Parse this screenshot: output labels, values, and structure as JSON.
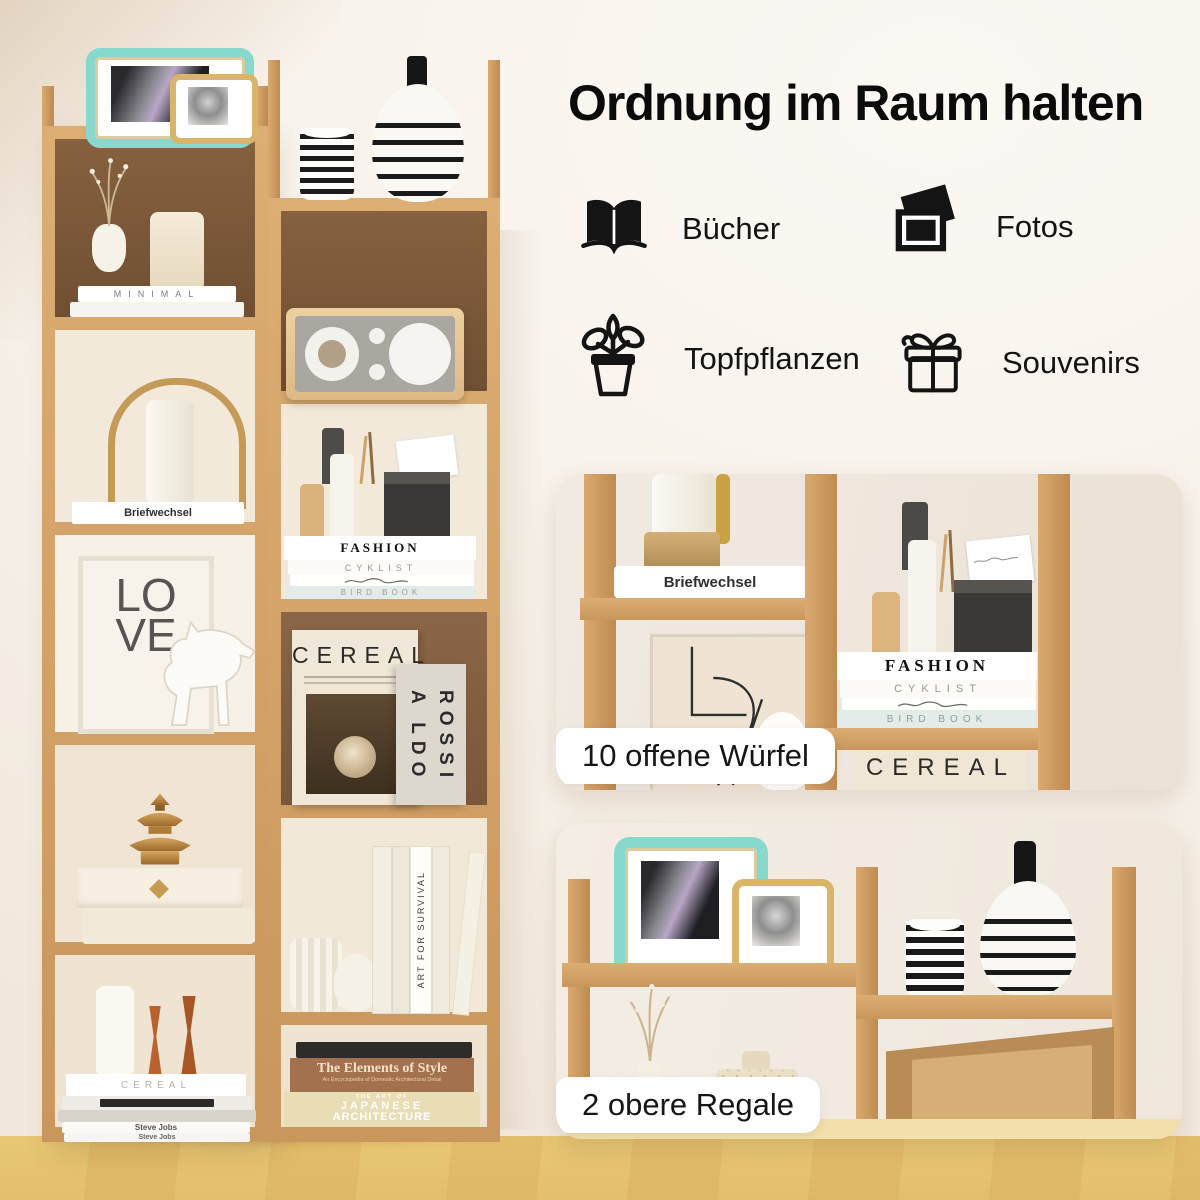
{
  "header": {
    "title": "Ordnung im Raum halten"
  },
  "features": [
    {
      "label": "Bücher",
      "icon": "open-book"
    },
    {
      "label": "Fotos",
      "icon": "photos"
    },
    {
      "label": "Topfpflanzen",
      "icon": "potted-plant"
    },
    {
      "label": "Souvenirs",
      "icon": "gift"
    }
  ],
  "insets": [
    {
      "caption": "10 offene Würfel"
    },
    {
      "caption": "2 obere Regale"
    }
  ],
  "shelf_texts": {
    "minimal": "MINIMAL",
    "briefwechsel": "Briefwechsel",
    "love_line1": "LO",
    "love_line2": "VE",
    "fashion": "FASHION",
    "cyklist": "CYKLIST",
    "bird_book": "BIRD BOOK",
    "cereal": "CEREAL",
    "aldo_rossi_a": "A LDO",
    "aldo_rossi_b": "ROSSI",
    "art_for_survival": "ART FOR SURVIVAL",
    "steve_jobs": "Steve Jobs",
    "elements_title": "The Elements of Style",
    "elements_subtitle": "An Encyclopedia of Domestic Architectural Detail",
    "japanese_pre": "THE ART OF",
    "japanese_1": "JAPANESE",
    "japanese_2": "ARCHITECTURE"
  },
  "colors": {
    "page_bg": "#f7f1ea",
    "title_text": "#0b0b0b",
    "icon_color": "#141414",
    "wood_frame": "#cf9e63",
    "wood_dark_back": "#7d5a3e",
    "floor": "#f1dda9",
    "caption_bg": "#ffffff",
    "caption_text": "#161616",
    "teal_frame": "#87d9cd",
    "gold_frame": "#d9b469"
  }
}
